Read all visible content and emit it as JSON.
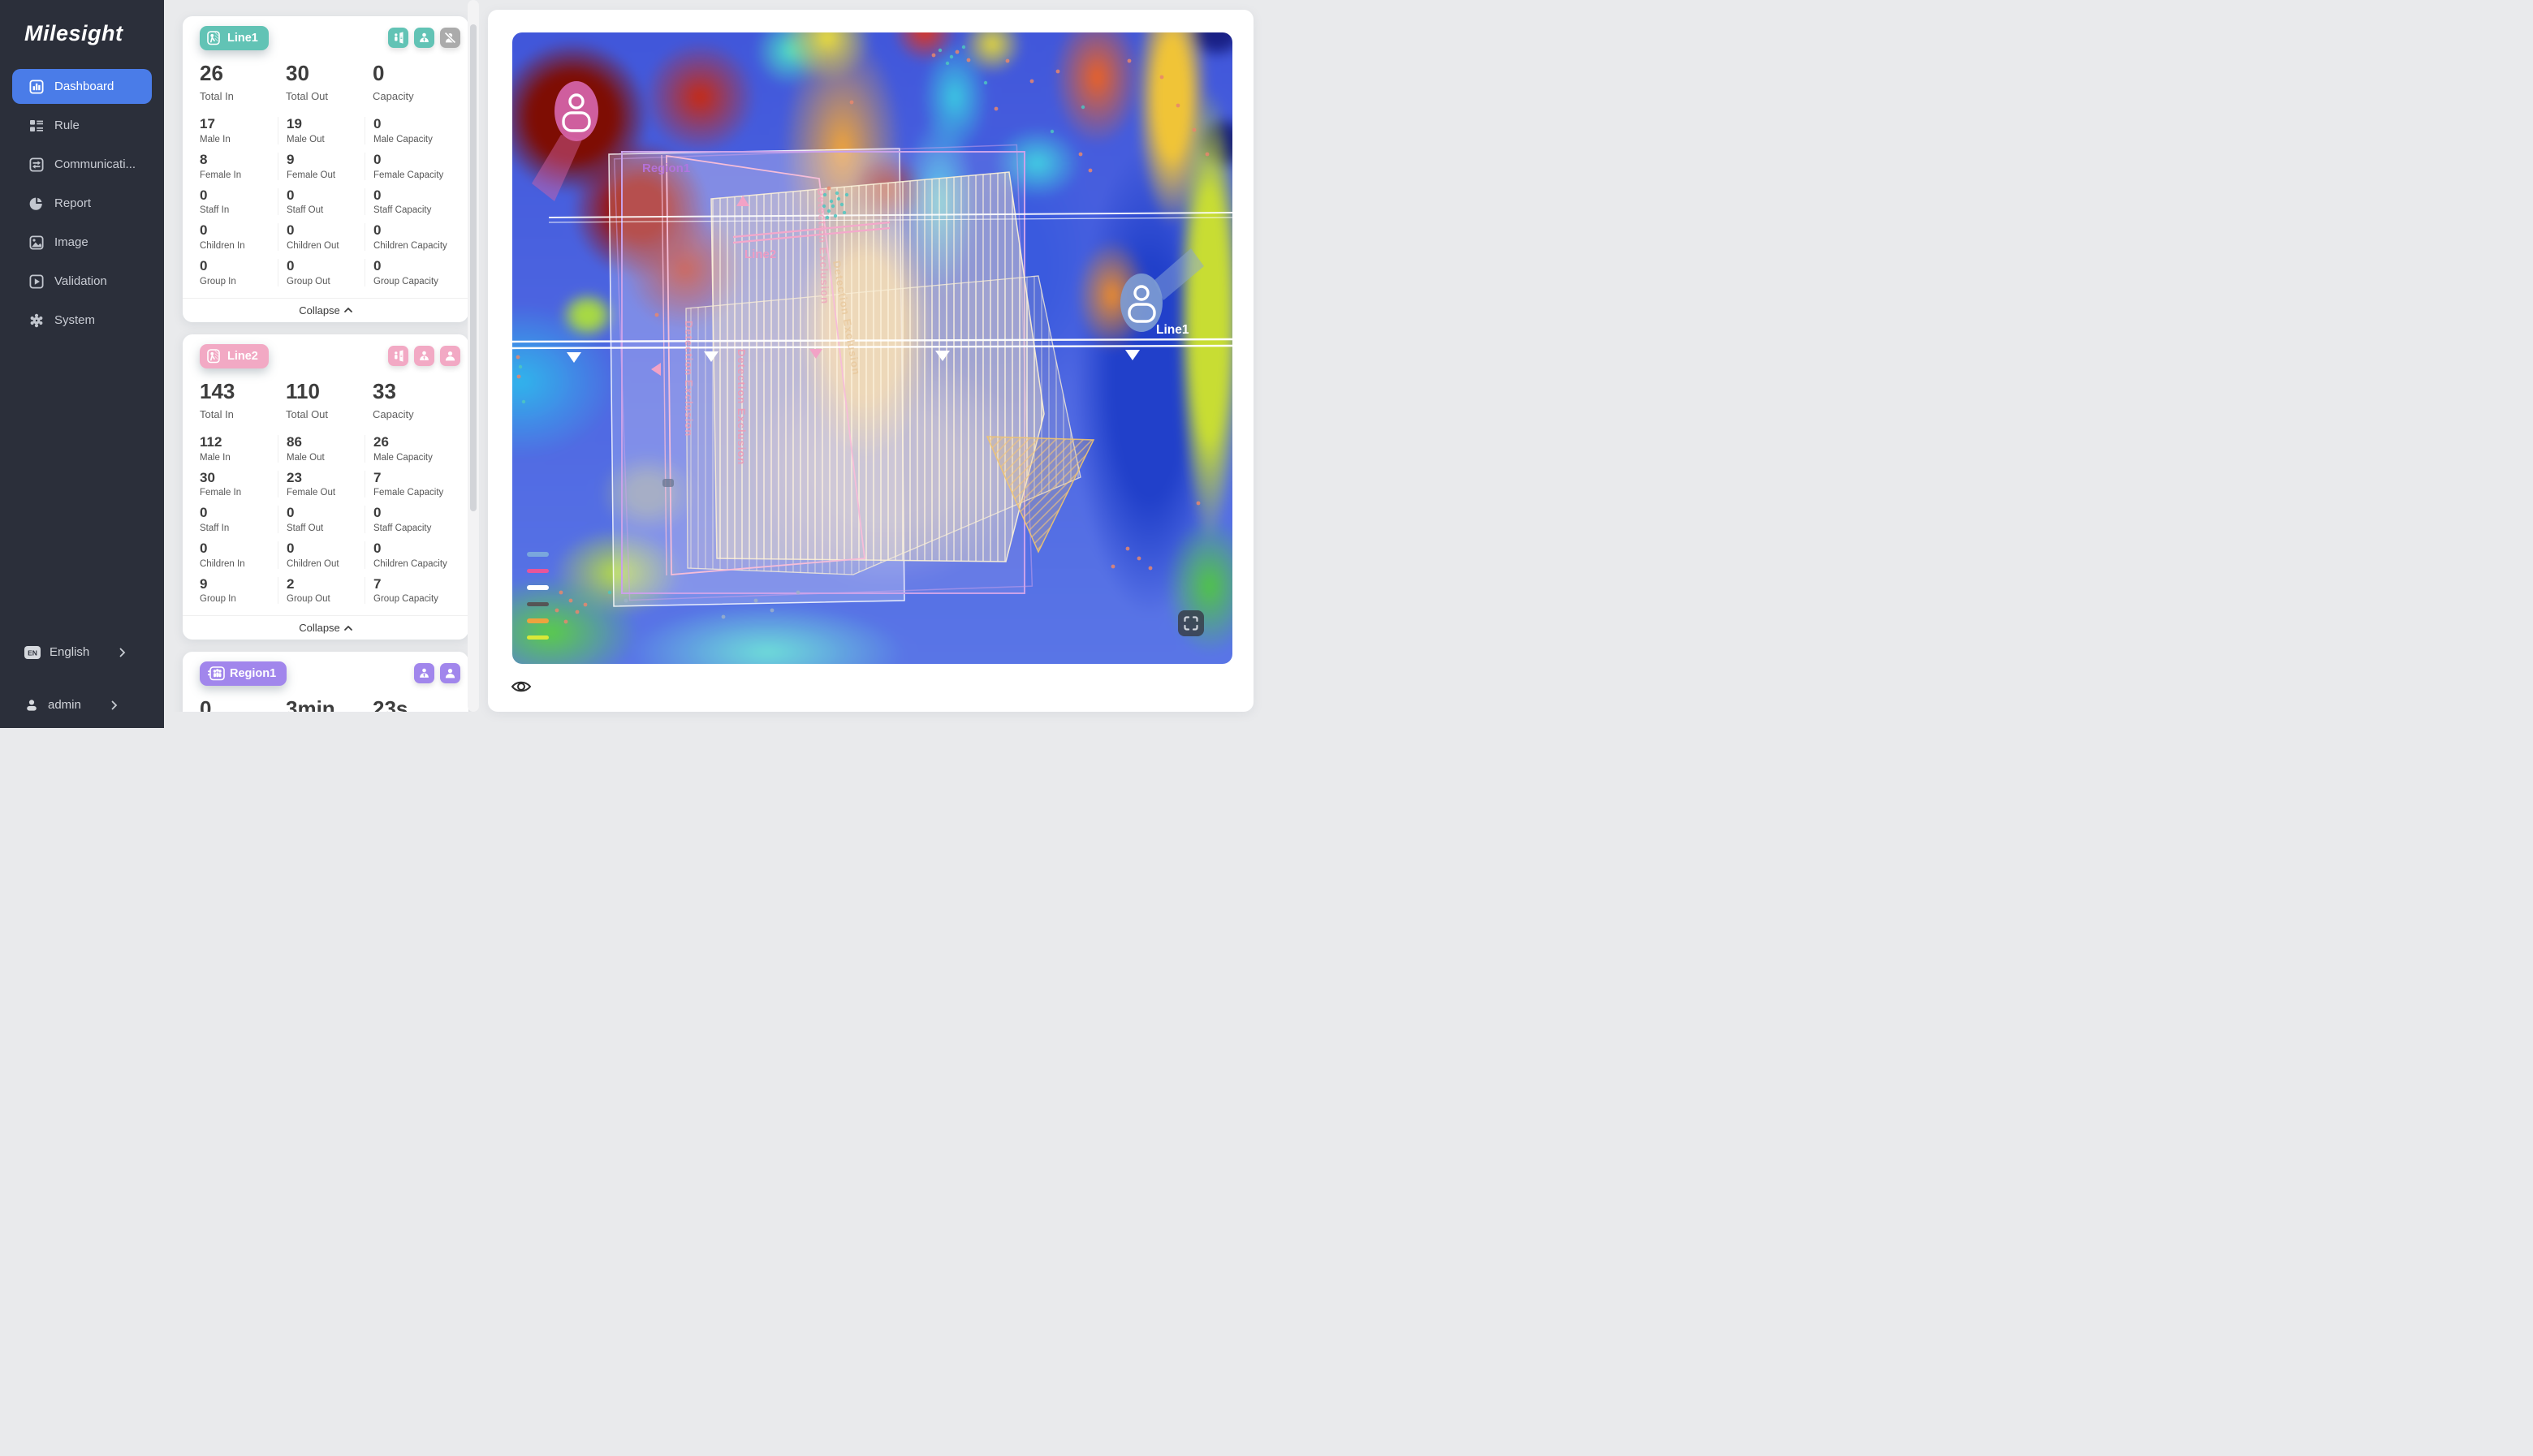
{
  "sidebar": {
    "logo": "Milesight",
    "items": [
      {
        "label": "Dashboard",
        "active": true
      },
      {
        "label": "Rule",
        "active": false
      },
      {
        "label": "Communicati...",
        "active": false
      },
      {
        "label": "Report",
        "active": false
      },
      {
        "label": "Image",
        "active": false
      },
      {
        "label": "Validation",
        "active": false
      },
      {
        "label": "System",
        "active": false
      }
    ],
    "language": {
      "badge": "EN",
      "label": "English"
    },
    "user": {
      "label": "admin"
    }
  },
  "cards": [
    {
      "name": "Line1",
      "collapse_label": "Collapse",
      "summary": [
        {
          "value": "26",
          "label": "Total In"
        },
        {
          "value": "30",
          "label": "Total Out"
        },
        {
          "value": "0",
          "label": "Capacity"
        }
      ],
      "stats": [
        {
          "value": "17",
          "label": "Male In"
        },
        {
          "value": "19",
          "label": "Male Out"
        },
        {
          "value": "0",
          "label": "Male Capacity"
        },
        {
          "value": "8",
          "label": "Female In"
        },
        {
          "value": "9",
          "label": "Female Out"
        },
        {
          "value": "0",
          "label": "Female Capacity"
        },
        {
          "value": "0",
          "label": "Staff In"
        },
        {
          "value": "0",
          "label": "Staff Out"
        },
        {
          "value": "0",
          "label": "Staff Capacity"
        },
        {
          "value": "0",
          "label": "Children In"
        },
        {
          "value": "0",
          "label": "Children Out"
        },
        {
          "value": "0",
          "label": "Children Capacity"
        },
        {
          "value": "0",
          "label": "Group In"
        },
        {
          "value": "0",
          "label": "Group Out"
        },
        {
          "value": "0",
          "label": "Group Capacity"
        }
      ]
    },
    {
      "name": "Line2",
      "collapse_label": "Collapse",
      "summary": [
        {
          "value": "143",
          "label": "Total In"
        },
        {
          "value": "110",
          "label": "Total Out"
        },
        {
          "value": "33",
          "label": "Capacity"
        }
      ],
      "stats": [
        {
          "value": "112",
          "label": "Male In"
        },
        {
          "value": "86",
          "label": "Male Out"
        },
        {
          "value": "26",
          "label": "Male Capacity"
        },
        {
          "value": "30",
          "label": "Female In"
        },
        {
          "value": "23",
          "label": "Female Out"
        },
        {
          "value": "7",
          "label": "Female Capacity"
        },
        {
          "value": "0",
          "label": "Staff In"
        },
        {
          "value": "0",
          "label": "Staff Out"
        },
        {
          "value": "0",
          "label": "Staff Capacity"
        },
        {
          "value": "0",
          "label": "Children In"
        },
        {
          "value": "0",
          "label": "Children Out"
        },
        {
          "value": "0",
          "label": "Children Capacity"
        },
        {
          "value": "9",
          "label": "Group In"
        },
        {
          "value": "2",
          "label": "Group Out"
        },
        {
          "value": "7",
          "label": "Group Capacity"
        }
      ]
    },
    {
      "name": "Region1",
      "summary": [
        {
          "value": "0",
          "label": ""
        },
        {
          "value": "3min 54s",
          "label": ""
        },
        {
          "value": "23s",
          "label": ""
        }
      ]
    }
  ],
  "map": {
    "region1_label": "Region1",
    "line1_label": "Line1",
    "line2_label": "Line2",
    "exclusion_label": "Detection Exclusion",
    "legend_colors": [
      "#7aa7dd",
      "#e8559a",
      "#ffffff",
      "#555555",
      "#eda33e",
      "#d8e838"
    ],
    "marker_pink": "#d463a7",
    "marker_blue": "#7d9bd3"
  },
  "accents": {
    "teal": "#62c3b5",
    "pink": "#f2a9c4",
    "purple": "#a186ec",
    "active_blue": "#4a7ce8",
    "disabled": "#ababab"
  }
}
